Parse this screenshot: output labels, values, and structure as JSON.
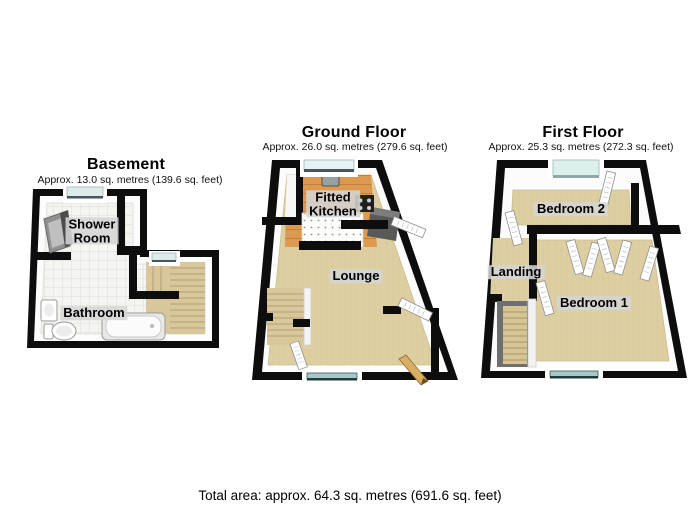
{
  "page": {
    "background": "#ffffff"
  },
  "floors": {
    "basement": {
      "title": "Basement",
      "area": "Approx. 13.0 sq. metres (139.6 sq. feet)",
      "rooms": {
        "shower_room": "Shower\nRoom",
        "bathroom": "Bathroom"
      }
    },
    "ground": {
      "title": "Ground Floor",
      "area": "Approx. 26.0 sq. metres (279.6 sq. feet)",
      "rooms": {
        "kitchen": "Fitted\nKitchen",
        "lounge": "Lounge"
      }
    },
    "first": {
      "title": "First Floor",
      "area": "Approx. 25.3 sq. metres (272.3 sq. feet)",
      "rooms": {
        "bedroom2": "Bedroom 2",
        "landing": "Landing",
        "bedroom1": "Bedroom 1"
      }
    }
  },
  "footer": {
    "total_area": "Total area: approx. 64.3 sq. metres (691.6 sq. feet)"
  },
  "colors": {
    "wall": "#0d0d0d",
    "carpet": "#ddcfa2",
    "kitchen_floor": "#dc9950",
    "tile_floor": "#f4f4f1",
    "window_glass": "#ddeeec",
    "stairs": "#d9c79c",
    "counter": "#595959",
    "label_chip": "#d6d6d6",
    "entrance_door": "#d9ae64"
  }
}
